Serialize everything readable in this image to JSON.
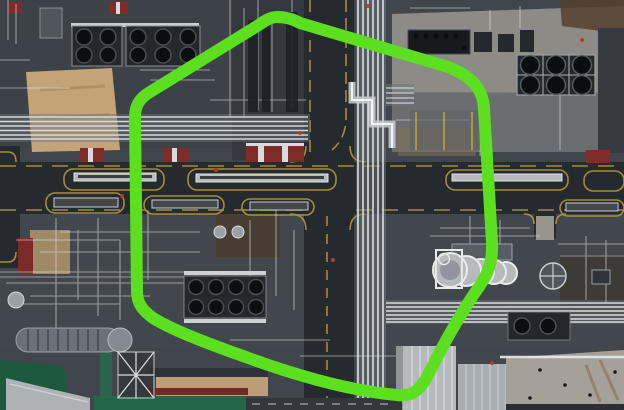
{
  "image": {
    "width": 624,
    "height": 410,
    "kind": "aerial-photograph",
    "subject": "Top-down aerial view of an oil refinery / petrochemical plant crossed by roads, white pipe racks, air-cooler fan banks and storage units, with a neon-green rounded hexagon outline drawn over the center"
  },
  "palette": {
    "ground": "#41464c",
    "ground_dark": "#35393f",
    "asphalt": "#26292d",
    "concrete": "#8c8b85",
    "concrete_bright": "#a6a198",
    "steel_white": "#e2e5e7",
    "steel_light": "#b6babd",
    "steel_mid": "#6d747b",
    "unit_dark": "#24282c",
    "fan_black": "#0b0e10",
    "red_zone": "#802c28",
    "maroon": "#6f2a25",
    "sand": "#c3a478",
    "vegetation": "#1d5a3d",
    "road_yellow": "#b89f3c",
    "accent_green": "#5bdf1f"
  },
  "overlay": {
    "shape": "rounded-hexagon-outline",
    "stroke_color": "#5bdf1f",
    "stroke_width": 12,
    "fill": "none",
    "path": "M 300 23 L 448 67 C 471 76 483 88 484 109 L 492 242 C 493 263 488 275 474 294 Q 452 327 428 375 C 420 391 411 397 397 395 C 352 391 300 377 243 356 C 206 343 172 330 153 318 C 142 310 137 303 137 291 L 135 117 C 135 105 140 98 150 92 L 254 28 C 262 23 269 17 277 17 C 286 17 293 19 300 23 Z"
  }
}
